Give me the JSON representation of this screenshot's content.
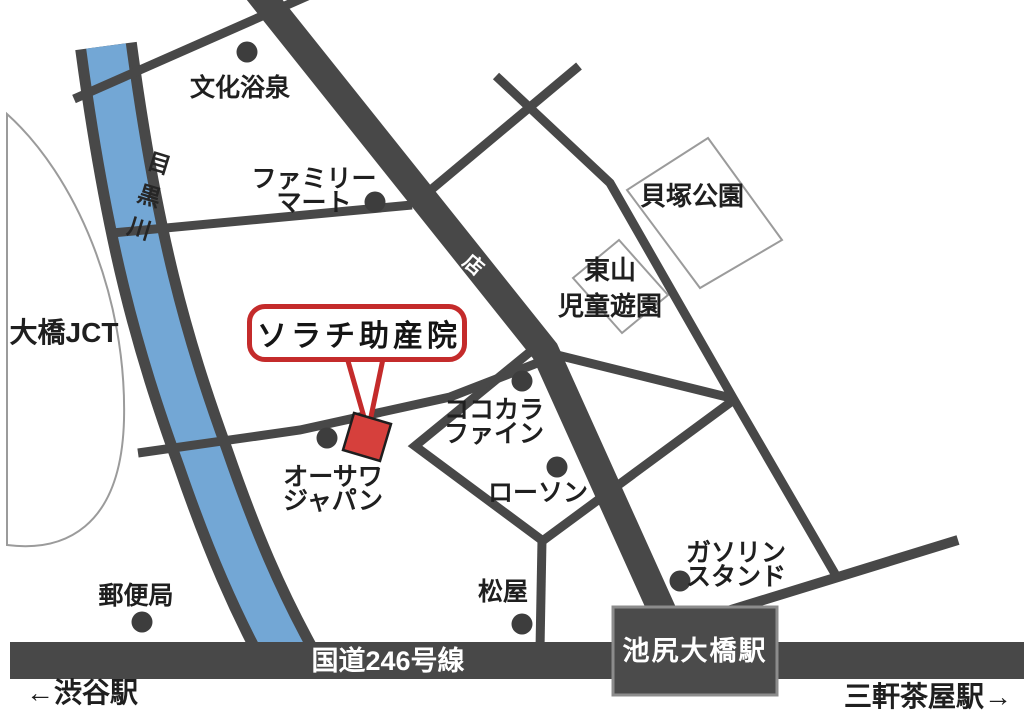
{
  "title": "ソラチ助産院",
  "roads": {
    "route246": "国道246号線",
    "shotengai": "商店街",
    "river": "目黒川"
  },
  "stations": {
    "ikejiri_ohashi": "池尻大橋駅",
    "shibuya_direction": "←渋谷駅",
    "sangenjaya_direction": "三軒茶屋駅→"
  },
  "areas": {
    "ohashi_jct": "大橋JCT",
    "kaizuka_park": "貝塚公園",
    "higashiyama_line1": "東山",
    "higashiyama_line2": "児童遊園"
  },
  "landmarks": [
    {
      "name": "bunka-yokusen",
      "lines": [
        "文化浴泉"
      ]
    },
    {
      "name": "family-mart",
      "lines": [
        "ファミリー",
        "マート"
      ]
    },
    {
      "name": "osawa-japan",
      "lines": [
        "オーサワ",
        "ジャパン"
      ]
    },
    {
      "name": "cocokara-fine",
      "lines": [
        "ココカラ",
        "ファイン"
      ]
    },
    {
      "name": "lawson",
      "lines": [
        "ローソン"
      ]
    },
    {
      "name": "matsuya",
      "lines": [
        "松屋"
      ]
    },
    {
      "name": "post-office",
      "lines": [
        "郵便局"
      ]
    },
    {
      "name": "gas-station",
      "lines": [
        "ガソリン",
        "スタンド"
      ]
    }
  ],
  "colors": {
    "road": "#484848",
    "river": "#73a7d5",
    "accent_red": "#c42b2b",
    "marker_red": "#d6403c",
    "station_fill": "#4b4b4b",
    "outline_gray": "#9b9b9b"
  }
}
